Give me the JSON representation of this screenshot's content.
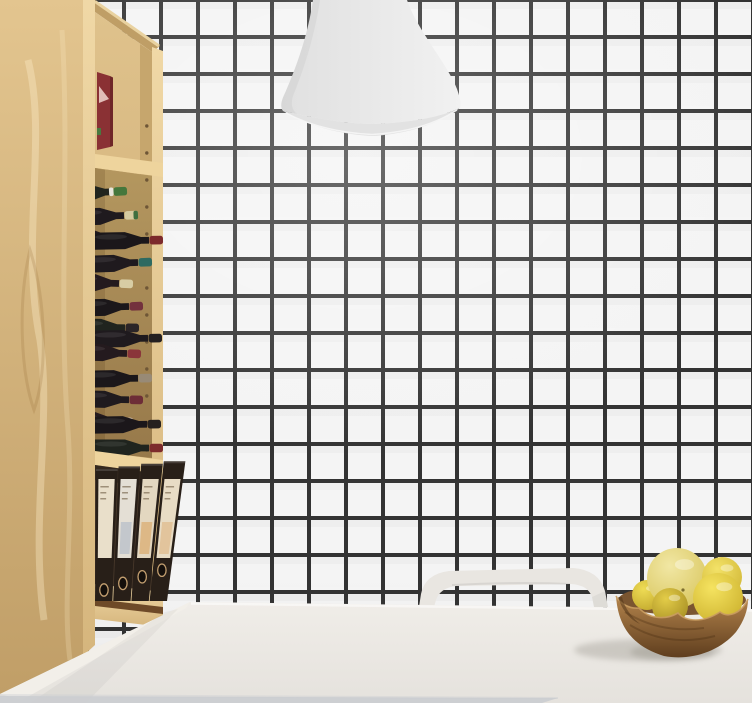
{
  "scene": {
    "type": "3d-render",
    "label": "Kitchen corner: white grid-tile wall with black grout, plywood bookcase used as wine rack with binders, gray pendant lamp, white table with arch-back chair and a wooden bowl of lemons"
  },
  "palette": {
    "tile": "#f4f4f4",
    "grout": "#333333",
    "wood-top": "#e3c58f",
    "wood-bottom": "#c09e67",
    "wood-edge-top": "#f0d8a6",
    "wood-edge-bottom": "#d6b67d",
    "wood-back-top": "#dfc28c",
    "wood-back-bottom": "#c9a56c",
    "wine-back-top": "#b4975f",
    "wine-back-bottom": "#97794a",
    "inner-wall": "#c6a66d",
    "shelf-edge": "#eed49d",
    "ceiling-wood": "#bf9e66",
    "lamp-left": "#e0e0e0",
    "lamp-right": "#f1f1f1",
    "lamp-rim": "#e2e2e2",
    "chair": "#e9e6e1",
    "chair-shadow": "#d2cec8",
    "table-top": "#f0ede8",
    "table-bottom": "#e5e2dd",
    "table-edge-sliver": "#f2efe9",
    "floor-strip": "#cbced1",
    "bowl-top": "#b5854d",
    "bowl-bottom": "#5f3e1e",
    "bowl-rim": "#c99c60",
    "binder-body": "#281f18",
    "binder-hole": "#140f0b",
    "binder-ring": "#c39f70",
    "book-red": "#8a3134",
    "book-red-dark": "#6e2628",
    "book-triangle": "#e2bdb8",
    "book-tag-green": "#49793f"
  },
  "wall": {
    "tile_size_px": 37,
    "grout_px": 4
  },
  "bookcase": {
    "wine_bottles": [
      {
        "y": 191,
        "tip_x": 127,
        "tilt": -3,
        "capsule": "#45773c",
        "body": "#20241e",
        "band": "#e7e5db",
        "band_pos": "base"
      },
      {
        "y": 215,
        "tip_x": 138,
        "tilt": -2,
        "capsule": "#d6cba0",
        "body": "#1f1a1e",
        "band": "#3f6f3f",
        "band_pos": "tip"
      },
      {
        "y": 238,
        "tip_x": 126,
        "tilt": 2,
        "capsule": "#cfc08e",
        "body": "#241a1e"
      },
      {
        "y": 240,
        "tip_x": 163,
        "tilt": -1,
        "capsule": "#7c2a2c",
        "body": "#1b171a"
      },
      {
        "y": 262,
        "tip_x": 152,
        "tilt": -2,
        "capsule": "#2e6a61",
        "body": "#1f1a1e"
      },
      {
        "y": 284,
        "tip_x": 133,
        "tilt": 2,
        "capsule": "#d8cda4",
        "body": "#241a1e"
      },
      {
        "y": 306,
        "tip_x": 143,
        "tilt": -2,
        "capsule": "#73313d",
        "body": "#1b171a"
      },
      {
        "y": 328,
        "tip_x": 139,
        "tilt": 1,
        "capsule": "#2b2527",
        "body": "#20241e"
      },
      {
        "y": 338,
        "tip_x": 162,
        "tilt": -1,
        "capsule": "#242021",
        "body": "#1f1a1e"
      },
      {
        "y": 354,
        "tip_x": 141,
        "tilt": 2,
        "capsule": "#8a353a",
        "body": "#241a1e"
      },
      {
        "y": 378,
        "tip_x": 152,
        "tilt": -1,
        "capsule": "#988a76",
        "body": "#1b171a"
      },
      {
        "y": 400,
        "tip_x": 143,
        "tilt": 1,
        "capsule": "#6d2d37",
        "body": "#1f1a1e"
      },
      {
        "y": 422,
        "tip_x": 133,
        "tilt": 2,
        "capsule": "#d6c2b0",
        "body": "#241a1e"
      },
      {
        "y": 424,
        "tip_x": 161,
        "tilt": -1,
        "capsule": "#26211f",
        "body": "#1b171a"
      },
      {
        "y": 448,
        "tip_x": 163,
        "tilt": 0,
        "capsule": "#7d2b2c",
        "body": "#20241e"
      }
    ],
    "peg_hole_ys": [
      126,
      153,
      180,
      207,
      234,
      261,
      288,
      315,
      342,
      369,
      396,
      423,
      450
    ],
    "binders": [
      {
        "label": "#e9dfca",
        "patch": null
      },
      {
        "label": "#e4dfd5",
        "patch": "#c3c7cc"
      },
      {
        "label": "#e3d7c0",
        "patch": "#ddb886"
      },
      {
        "label": "#e8dcc5",
        "patch": "#e2c49c"
      }
    ]
  },
  "fruit_bowl": {
    "lemons": [
      {
        "cx": 647,
        "cy": 595,
        "r": 15,
        "hi": "#eedc55",
        "lo": "#c3a92e"
      },
      {
        "cx": 677,
        "cy": 578,
        "r": 30,
        "hi": "#f1e7a4",
        "lo": "#d9c65e"
      },
      {
        "cx": 722,
        "cy": 577,
        "r": 20,
        "hi": "#f3e268",
        "lo": "#d2b838"
      },
      {
        "cx": 718,
        "cy": 598,
        "r": 25,
        "hi": "#f5e360",
        "lo": "#cdb22e"
      },
      {
        "cx": 670,
        "cy": 606,
        "r": 18,
        "hi": "#e3cc48",
        "lo": "#a78f24"
      }
    ]
  }
}
